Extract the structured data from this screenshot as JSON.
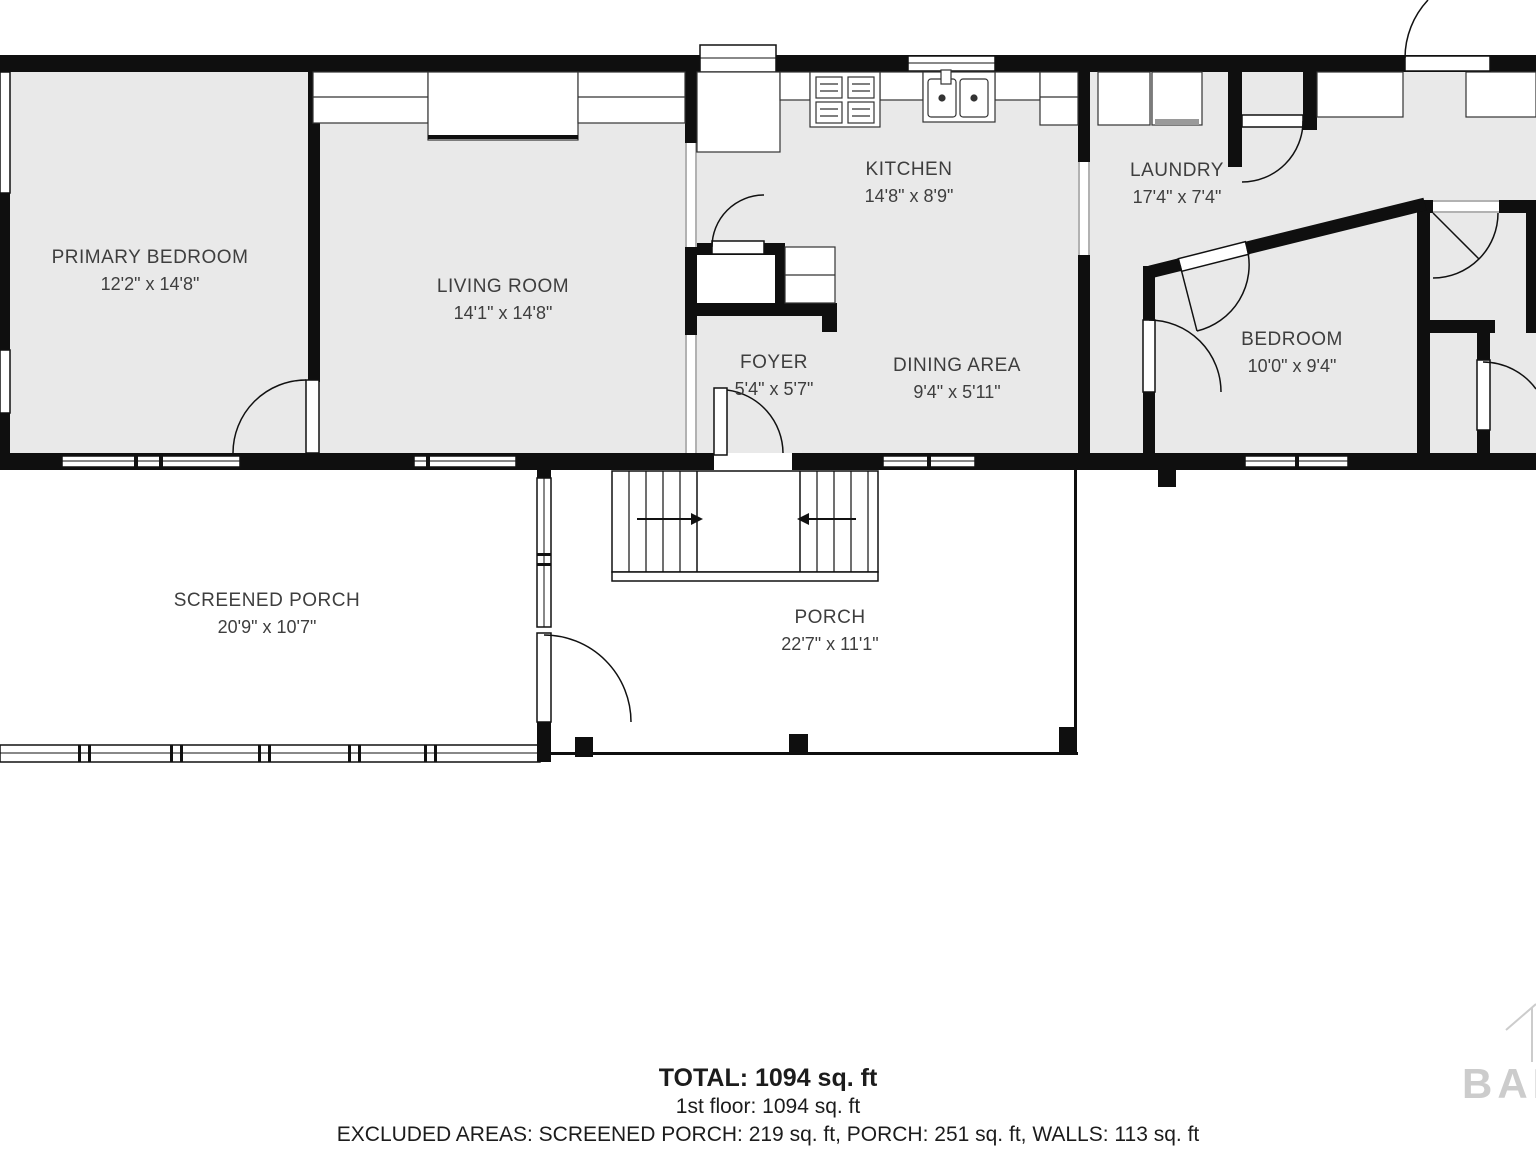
{
  "rooms": [
    {
      "name": "PRIMARY BEDROOM",
      "dims": "12'2\" x 14'8\""
    },
    {
      "name": "LIVING ROOM",
      "dims": "14'1\" x 14'8\""
    },
    {
      "name": "KITCHEN",
      "dims": "14'8\" x 8'9\""
    },
    {
      "name": "LAUNDRY",
      "dims": "17'4\" x 7'4\""
    },
    {
      "name": "FOYER",
      "dims": "5'4\" x 5'7\""
    },
    {
      "name": "DINING AREA",
      "dims": "9'4\" x 5'11\""
    },
    {
      "name": "BEDROOM",
      "dims": "10'0\" x 9'4\""
    },
    {
      "name": "SCREENED PORCH",
      "dims": "20'9\" x 10'7\""
    },
    {
      "name": "PORCH",
      "dims": "22'7\" x 11'1\""
    }
  ],
  "summary": {
    "total": "TOTAL: 1094 sq. ft",
    "first_floor": "1st floor: 1094 sq. ft",
    "excluded": "EXCLUDED AREAS: SCREENED PORCH: 219 sq. ft, PORCH: 251 sq. ft, WALLS: 113 sq. ft"
  },
  "watermark": {
    "text": "BALL"
  },
  "colors": {
    "wall": "#0f0f0f",
    "room_fill": "#e9e9e9",
    "label": "#3e3e3e",
    "watermark": "#cccccc"
  }
}
